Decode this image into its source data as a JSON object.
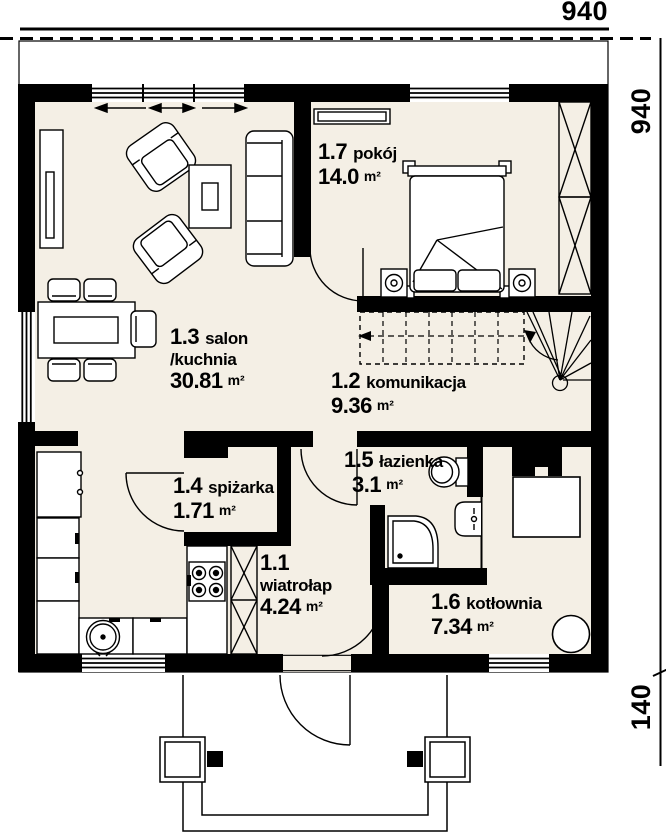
{
  "plan_title": "floor-plan",
  "dimensions": {
    "top": "940",
    "right": "940",
    "porch": "140"
  },
  "rooms": [
    {
      "id": "1.7",
      "name": "pokój",
      "name2": "",
      "area": "14.0",
      "unit": "m²"
    },
    {
      "id": "1.3",
      "name": "salon",
      "name2": "/kuchnia",
      "area": "30.81",
      "unit": "m²"
    },
    {
      "id": "1.2",
      "name": "komunikacja",
      "name2": "",
      "area": "9.36",
      "unit": "m²"
    },
    {
      "id": "1.4",
      "name": "spiżarka",
      "name2": "",
      "area": "1.71",
      "unit": "m²"
    },
    {
      "id": "1.5",
      "name": "łazienka",
      "name2": "",
      "area": "3.1",
      "unit": "m²"
    },
    {
      "id": "1.1",
      "name": "",
      "name2": "wiatrołap",
      "area": "4.24",
      "unit": "m²"
    },
    {
      "id": "1.6",
      "name": "kotłownia",
      "name2": "",
      "area": "7.34",
      "unit": "m²"
    }
  ],
  "colors": {
    "floor": "#f4efe5",
    "wall": "#000000",
    "background": "#ffffff"
  }
}
